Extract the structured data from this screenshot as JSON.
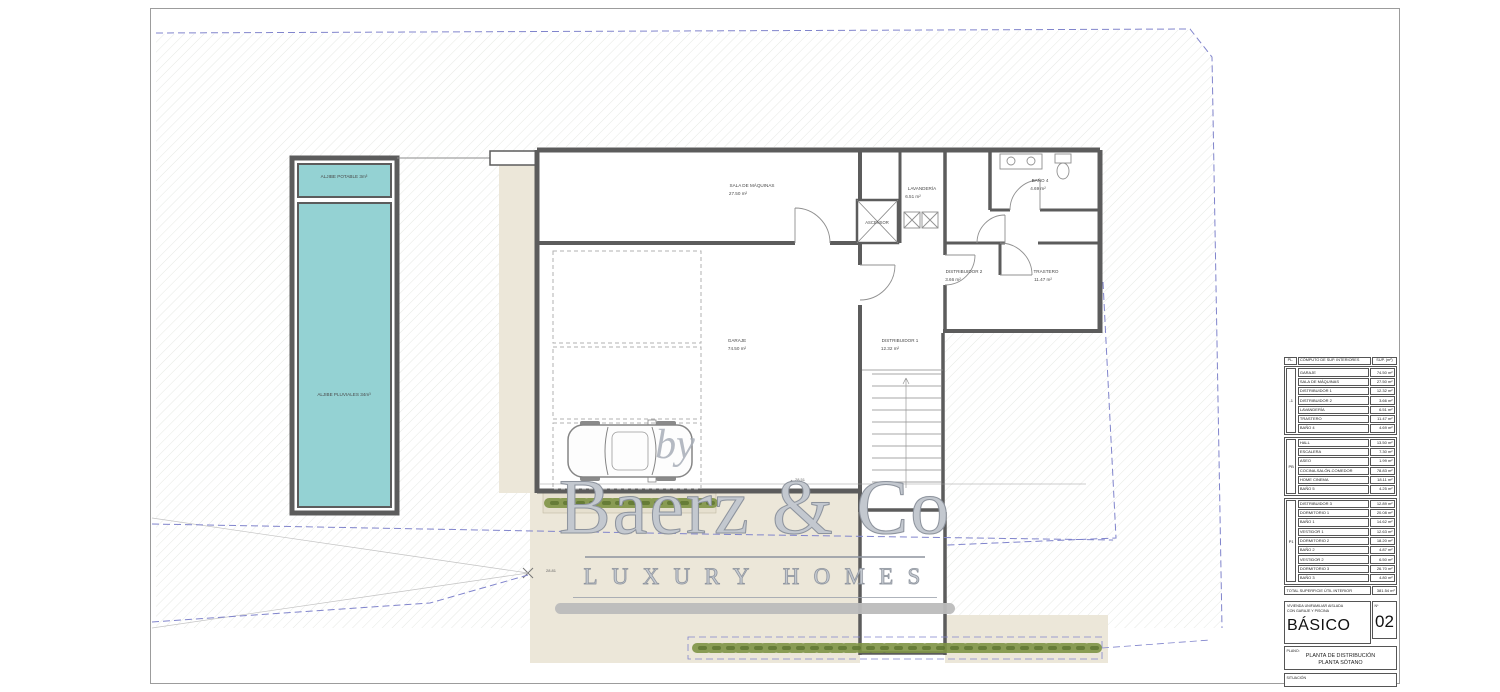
{
  "watermark": {
    "by": "by",
    "brand": "Baerz & Co",
    "tagline": "LUXURY HOMES"
  },
  "plan": {
    "rooms": {
      "aljibe_potable": {
        "label": "ALJIBE POTABLE 3m³"
      },
      "aljibe_pluviales": {
        "label": "ALJIBE PLUVIALES 34m³"
      },
      "sala_de_maquinas": {
        "label": "SALA DE MÁQUINAS",
        "area": "27.50 m²"
      },
      "garaje": {
        "label": "GARAJE",
        "area": "74.50 m²"
      },
      "distribuidor_1": {
        "label": "DISTRIBUIDOR 1",
        "area": "12.32 m²"
      },
      "distribuidor_2": {
        "label": "DISTRIBUIDOR 2",
        "area": "3.66 m²"
      },
      "lavanderia": {
        "label": "LAVANDERÍA",
        "area": "6.51 m²"
      },
      "trastero": {
        "label": "TRASTERO",
        "area": "11.47 m²"
      },
      "bano_4": {
        "label": "BAÑO 4",
        "area": "4.69 m²"
      },
      "ascensor": {
        "label": "ASCENSOR"
      }
    },
    "dimensions": {
      "bottom": "28.51",
      "corner": "28.81"
    }
  },
  "areas_table": {
    "headers": {
      "col_pl": "PL.",
      "col_name": "CÓMPUTO DE SUP. INTERIORES",
      "col_sup": "SUP. (m²)"
    },
    "sections": [
      {
        "pl": "-1",
        "rows": [
          [
            "GARAJE",
            "74.50 m²"
          ],
          [
            "SALA DE MÁQUINAS",
            "27.50 m²"
          ],
          [
            "DISTRIBUIDOR 1",
            "12.32 m²"
          ],
          [
            "DISTRIBUIDOR 2",
            "3.66 m²"
          ],
          [
            "LAVANDERÍA",
            "6.51 m²"
          ],
          [
            "TRASTERO",
            "11.47 m²"
          ],
          [
            "BAÑO 4",
            "4.69 m²"
          ]
        ]
      },
      {
        "pl": "PB",
        "rows": [
          [
            "HALL",
            "13.50 m²"
          ],
          [
            "ESCALERA",
            "7.30 m²"
          ],
          [
            "ASEO",
            "1.99 m²"
          ],
          [
            "COCINA-SALÓN-COMEDOR",
            "78.83 m²"
          ],
          [
            "HOME CINEMA",
            "18.11 m²"
          ],
          [
            "BAÑO 5",
            "4.25 m²"
          ]
        ]
      },
      {
        "pl": "P1",
        "rows": [
          [
            "DISTRIBUIDOR 3",
            "12.89 m²"
          ],
          [
            "DORMITORIO 1",
            "20.08 m²"
          ],
          [
            "BAÑO 1",
            "14.62 m²"
          ],
          [
            "VESTIDOR 1",
            "12.63 m²"
          ],
          [
            "DORMITORIO 2",
            "18.20 m²"
          ],
          [
            "BAÑO 2",
            "4.87 m²"
          ],
          [
            "VESTIDOR 2",
            "6.50 m²"
          ],
          [
            "DORMITORIO 3",
            "26.70 m²"
          ],
          [
            "BAÑO 3",
            "4.80 m²"
          ]
        ]
      }
    ],
    "total_label": "TOTAL SUPERFICIE ÚTIL INTERIOR",
    "total_value": "381.54 m²"
  },
  "title_block": {
    "project_line1": "VIVIENDA UNIFAMILIAR AISLADA",
    "project_line2": "CON GARAJE Y PISCINA",
    "phase": "BÁSICO",
    "number_label": "Nº",
    "number": "02",
    "plano_label": "PLANO:",
    "plano_line1": "PLANTA DE DISTRIBUCIÓN",
    "plano_line2": "PLANTA SÓTANO",
    "situacion_label": "SITUACIÓN"
  },
  "colors": {
    "wall": "#5c5c5c",
    "water_tank": "#94d2d3",
    "terrain_beige": "#ece7d9",
    "boundary_blue": "#8084cc",
    "hatch": "#cbd0c5",
    "vegetation": "#7e9445",
    "watermark_gray": "#8d939d"
  }
}
